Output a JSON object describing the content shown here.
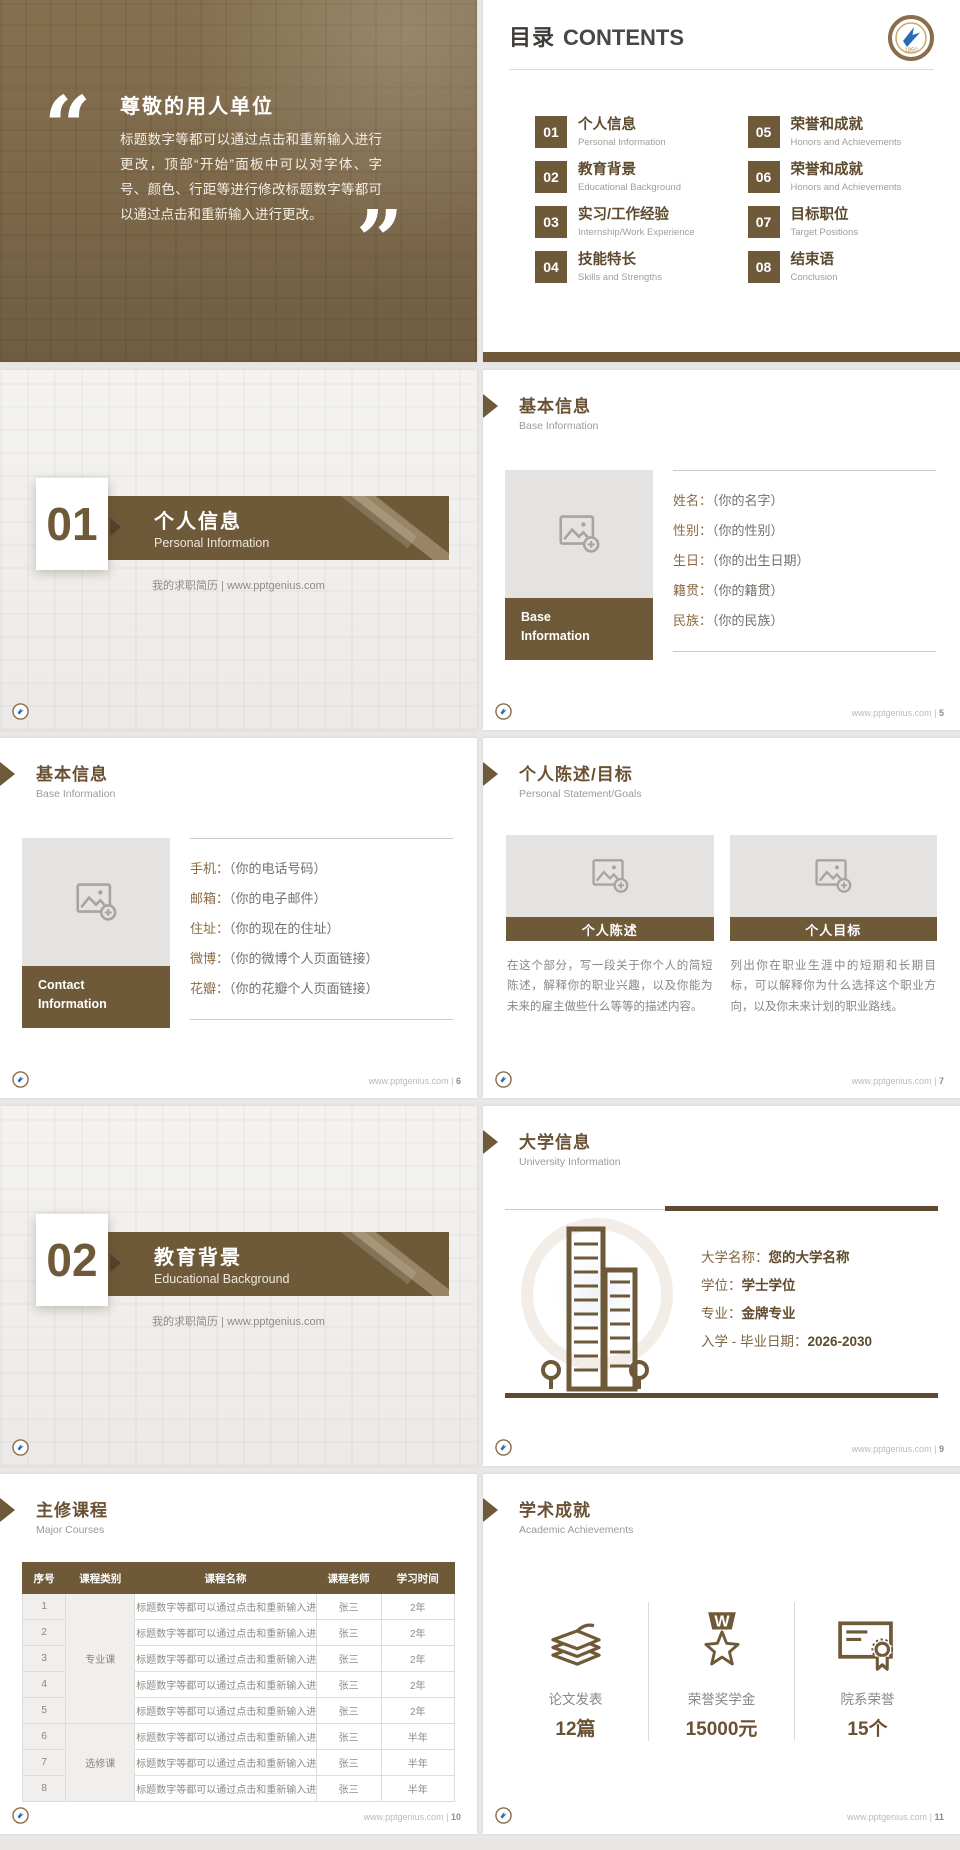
{
  "brand": {
    "site": "www.pptgenius.com",
    "sep": "|",
    "badge_year": "1950",
    "accent_color": "#6e5939"
  },
  "slide_quote": {
    "open_quote": "“",
    "close_quote": "”",
    "heading": "尊敬的用人单位",
    "body": "标题数字等都可以通过点击和重新输入进行更改，顶部“开始”面板中可以对字体、字号、颜色、行距等进行修改标题数字等都可以通过点击和重新输入进行更改。"
  },
  "slide_contents": {
    "title_zh": "目录",
    "title_en": "CONTENTS",
    "items": [
      {
        "num": "01",
        "zh": "个人信息",
        "en": "Personal Information"
      },
      {
        "num": "02",
        "zh": "教育背景",
        "en": "Educational Background"
      },
      {
        "num": "03",
        "zh": "实习/工作经验",
        "en": "Internship/Work Experience"
      },
      {
        "num": "04",
        "zh": "技能特长",
        "en": "Skills and Strengths"
      },
      {
        "num": "05",
        "zh": "荣誉和成就",
        "en": "Honors and Achievements"
      },
      {
        "num": "06",
        "zh": "荣誉和成就",
        "en": "Honors and Achievements"
      },
      {
        "num": "07",
        "zh": "目标职位",
        "en": "Target Positions"
      },
      {
        "num": "08",
        "zh": "结束语",
        "en": "Conclusion"
      }
    ]
  },
  "slide_section_1": {
    "num": "01",
    "title_zh": "个人信息",
    "title_en": "Personal Information",
    "tagline": "我的求职简历 | www.pptgenius.com"
  },
  "slide_section_2": {
    "num": "02",
    "title_zh": "教育背景",
    "title_en": "Educational Background",
    "tagline": "我的求职简历 | www.pptgenius.com"
  },
  "slide_base_info": {
    "title_zh": "基本信息",
    "title_en": "Base Information",
    "page": "5",
    "caption_line1": "Base",
    "caption_line2": "Information",
    "fields": [
      {
        "label": "姓名：",
        "value": "（你的名字）"
      },
      {
        "label": "性别：",
        "value": "（你的性别）"
      },
      {
        "label": "生日：",
        "value": "（你的出生日期）"
      },
      {
        "label": "籍贯：",
        "value": "（你的籍贯）"
      },
      {
        "label": "民族：",
        "value": "（你的民族）"
      }
    ]
  },
  "slide_contact": {
    "title_zh": "基本信息",
    "title_en": "Base Information",
    "page": "6",
    "caption_line1": "Contact",
    "caption_line2": "Information",
    "fields": [
      {
        "label": "手机：",
        "value": "（你的电话号码）"
      },
      {
        "label": "邮箱：",
        "value": "（你的电子邮件）"
      },
      {
        "label": "住址：",
        "value": "（你的现在的住址）"
      },
      {
        "label": "微博：",
        "value": "（你的微博个人页面链接）"
      },
      {
        "label": "花瓣：",
        "value": "（你的花瓣个人页面链接）"
      }
    ]
  },
  "slide_statement": {
    "title_zh": "个人陈述/目标",
    "title_en": "Personal Statement/Goals",
    "page": "7",
    "panels": [
      {
        "caption": "个人陈述",
        "text": "在这个部分，写一段关于你个人的简短陈述，解释你的职业兴趣，以及你能为未来的雇主做些什么等等的描述内容。"
      },
      {
        "caption": "个人目标",
        "text": "列出你在职业生涯中的短期和长期目标，可以解释你为什么选择这个职业方向，以及你未来计划的职业路线。"
      }
    ]
  },
  "slide_university": {
    "title_zh": "大学信息",
    "title_en": "University Information",
    "page": "9",
    "fields": [
      {
        "label": "大学名称：",
        "value": "您的大学名称"
      },
      {
        "label": "学位：",
        "value": "学士学位"
      },
      {
        "label": "专业：",
        "value": "金牌专业"
      },
      {
        "label": "入学 - 毕业日期：",
        "value": "2026-2030"
      }
    ]
  },
  "slide_courses": {
    "title_zh": "主修课程",
    "title_en": "Major Courses",
    "page": "10",
    "table": {
      "headers": [
        "序号",
        "课程类别",
        "课程名称",
        "课程老师",
        "学习时间"
      ],
      "categories": [
        {
          "label": "专业课",
          "span": 5
        },
        {
          "label": "选修课",
          "span": 3
        }
      ],
      "rows": [
        {
          "no": "1",
          "name": "标题数字等都可以通过点击和重新输入进行更改",
          "teacher": "张三",
          "time": "2年"
        },
        {
          "no": "2",
          "name": "标题数字等都可以通过点击和重新输入进行更改",
          "teacher": "张三",
          "time": "2年"
        },
        {
          "no": "3",
          "name": "标题数字等都可以通过点击和重新输入进行更改",
          "teacher": "张三",
          "time": "2年"
        },
        {
          "no": "4",
          "name": "标题数字等都可以通过点击和重新输入进行更改",
          "teacher": "张三",
          "time": "2年"
        },
        {
          "no": "5",
          "name": "标题数字等都可以通过点击和重新输入进行更改",
          "teacher": "张三",
          "time": "2年"
        },
        {
          "no": "6",
          "name": "标题数字等都可以通过点击和重新输入进行更改",
          "teacher": "张三",
          "time": "半年"
        },
        {
          "no": "7",
          "name": "标题数字等都可以通过点击和重新输入进行更改",
          "teacher": "张三",
          "time": "半年"
        },
        {
          "no": "8",
          "name": "标题数字等都可以通过点击和重新输入进行更改",
          "teacher": "张三",
          "time": "半年"
        }
      ]
    }
  },
  "slide_achievements": {
    "title_zh": "学术成就",
    "title_en": "Academic Achievements",
    "page": "11",
    "medal_letter": "W",
    "stats": [
      {
        "icon": "papers-icon",
        "label": "论文发表",
        "value": "12篇"
      },
      {
        "icon": "medal-icon",
        "label": "荣誉奖学金",
        "value": "15000元"
      },
      {
        "icon": "certificate-icon",
        "label": "院系荣誉",
        "value": "15个"
      }
    ]
  }
}
